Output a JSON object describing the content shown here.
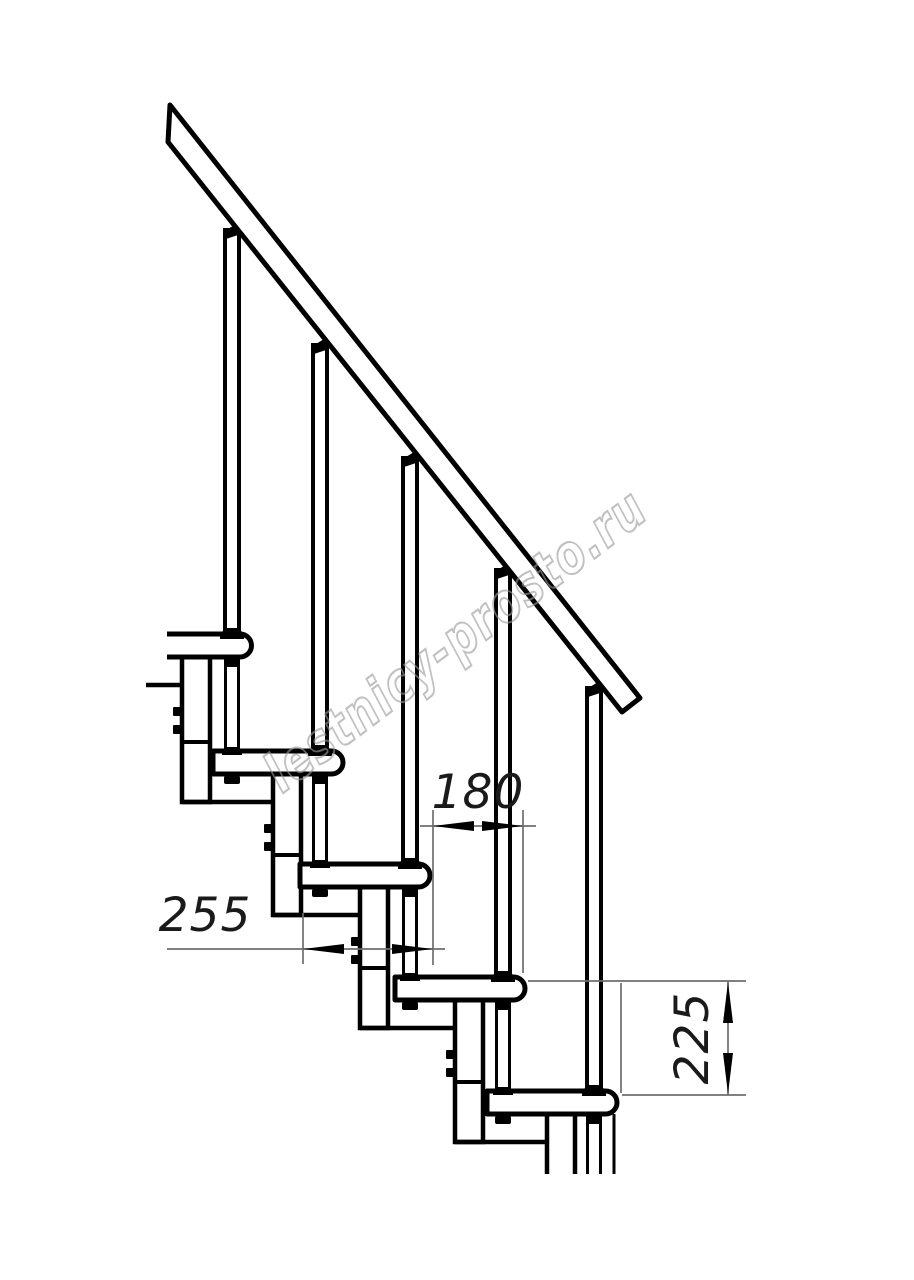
{
  "drawing": {
    "title": "modular-staircase-side-elevation",
    "type": "technical-line-drawing",
    "background_color": "#ffffff",
    "line_color": "#000000",
    "dim_line_color": "#6e6e6e",
    "watermark_color": "#9b9b9b",
    "dimensions": {
      "step_run": {
        "value": "180",
        "orientation": "horizontal",
        "meaning": "horizontal offset between tread noses (mm)"
      },
      "tread_depth": {
        "value": "255",
        "orientation": "horizontal",
        "meaning": "tread depth (mm)"
      },
      "step_rise": {
        "value": "225",
        "orientation": "vertical",
        "meaning": "rise between tread tops (mm)"
      }
    },
    "watermark": {
      "text": "lestnicy-prosto.ru"
    },
    "parts": {
      "handrail": "inclined handrail",
      "balusters": 5,
      "treads": 5,
      "riser_columns": 5
    }
  }
}
